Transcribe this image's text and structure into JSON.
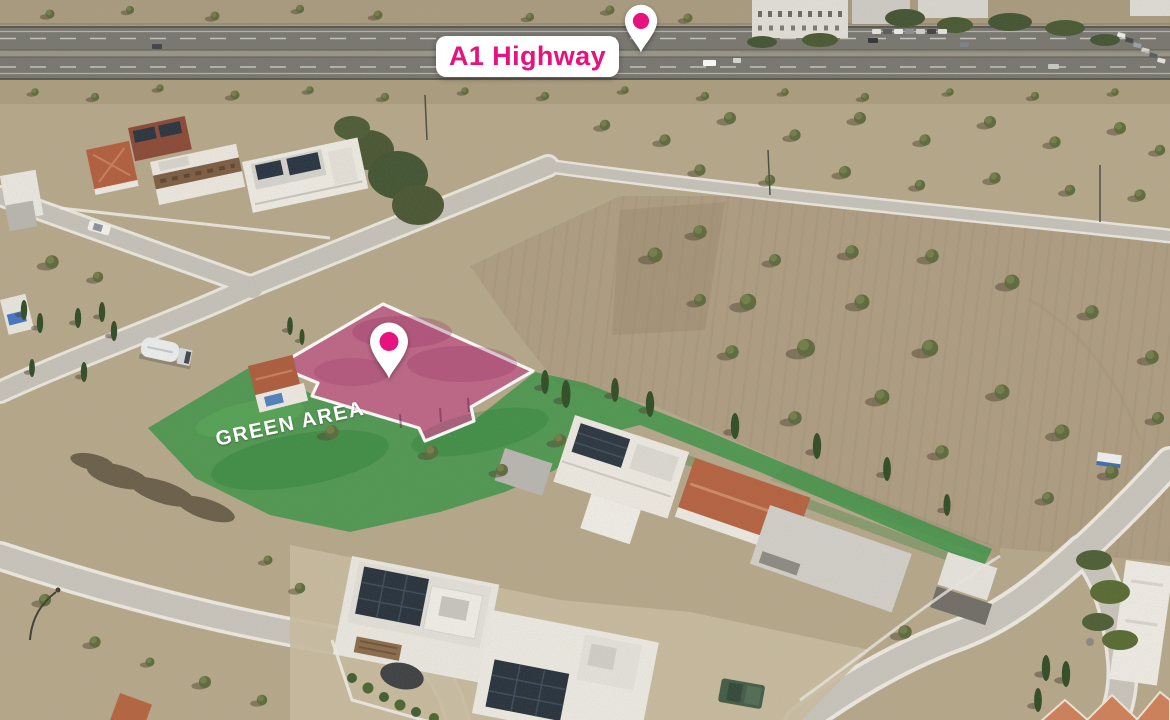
{
  "annotations": {
    "highway_label": {
      "text": "A1 Highway"
    },
    "green_area_label": {
      "text": "GREEN AREA"
    },
    "highway_pin_icon": "map-pin-icon",
    "plot_pin_icon": "map-pin-icon"
  },
  "scene": {
    "regions": [
      "highway",
      "residential-houses",
      "plowed-field",
      "green-area",
      "highlighted-plot",
      "roads"
    ]
  },
  "theme": {
    "accent": "#E8127F",
    "label-bg": "#FFFFFF",
    "label-text": "#E8127F",
    "green-label-text": "#FFFFFF",
    "plot-fill": "#C62582",
    "plot-border": "#FFFFFF",
    "green-fill": "#2F9240",
    "pin-fill": "#FFFFFF",
    "pin-dot": "#E8127F"
  }
}
